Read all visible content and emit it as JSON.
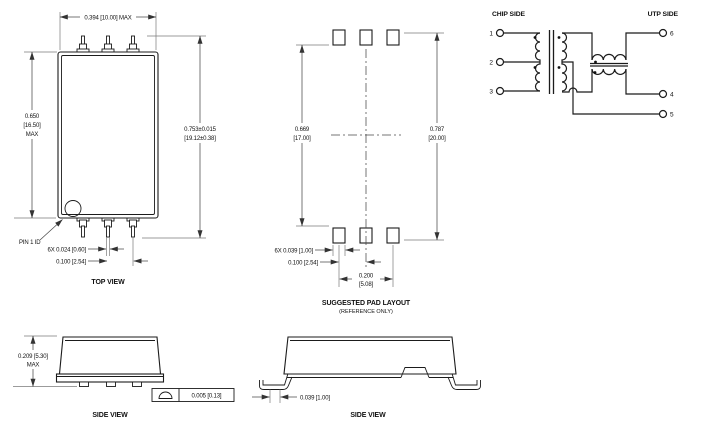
{
  "drawing": {
    "top_view": {
      "label": "TOP VIEW",
      "pin1_label": "PIN 1 ID",
      "dim_body_width": "0.394 [10.00] MAX",
      "dim_body_height": [
        "0.650",
        "[16.50]",
        "MAX"
      ],
      "dim_lead_span": [
        "0.753±0.015",
        "[19.12±0.38]"
      ],
      "dim_lead_width": "6X  0.024 [0.60]",
      "dim_lead_pitch": "0.100 [2.54]"
    },
    "pad_layout": {
      "label": "SUGGESTED PAD LAYOUT",
      "sublabel": "(REFERENCE ONLY)",
      "dim_rows_inner": [
        "0.669",
        "[17.00]"
      ],
      "dim_rows_outer": [
        "0.787",
        "[20.00]"
      ],
      "dim_pad_width": "6X  0.039 [1.00]",
      "dim_pad_pitch": "0.100 [2.54]",
      "dim_pad_span": [
        "0.200",
        "[5.08]"
      ]
    },
    "schematic": {
      "chip_side_label": "CHIP SIDE",
      "utp_side_label": "UTP SIDE",
      "left_pins": [
        "1",
        "2",
        "3"
      ],
      "right_pins": [
        "6",
        "4",
        "5"
      ]
    },
    "side_view_front": {
      "label": "SIDE VIEW",
      "dim_height": [
        "0.209 [5.30]",
        "MAX"
      ],
      "coplanarity": "0.005 [0.13]"
    },
    "side_view_long": {
      "label": "SIDE VIEW",
      "dim_standoff": "0.039 [1.00]"
    },
    "colors": {
      "line": "#1b1b1b",
      "dim": "#4a4a4a",
      "background": "#ffffff"
    }
  }
}
